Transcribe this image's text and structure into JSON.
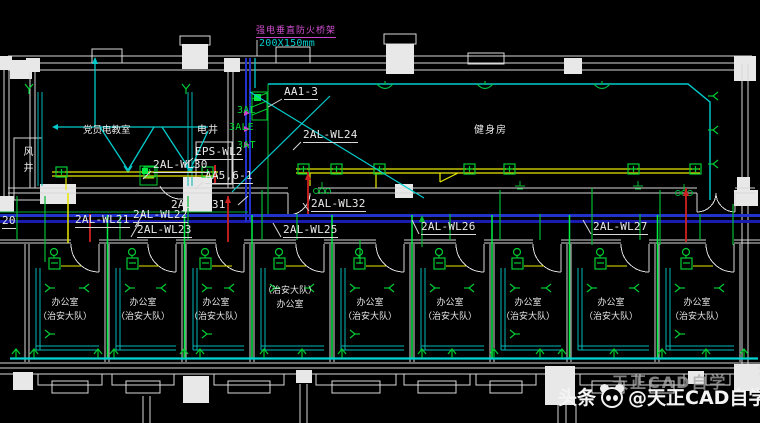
{
  "colors": {
    "background": "#000000",
    "wall_white": "#d9d9d9",
    "wire_cyan": "#00cccc",
    "wire_yellow": "#e8e800",
    "wire_green": "#00cc33",
    "riser_green_bright": "#00ee44",
    "tray_blue": "#2233cc",
    "wire_red": "#cc2222",
    "note_magenta": "#cc44cc"
  },
  "note": {
    "line1": "强电垂直防火桥架",
    "line2": "200X150mm"
  },
  "shaft_panels": {
    "p1": "3AL",
    "p2": "3ALE",
    "p3": "3AT"
  },
  "wire_labels": {
    "aa1_3": "AA1-3",
    "eps_wl2": "EPS-WL2",
    "wl30": "2AL-WL30",
    "aa5_6_1": "AA5,6-1",
    "wl31": "2AL-WL31",
    "wl24": "2AL-WL24",
    "wl32": "2AL-WL32",
    "wl20": "20",
    "wl21": "2AL-WL21",
    "wl22": "2AL-WL22",
    "wl23": "2AL-WL23",
    "wl25": "2AL-WL25",
    "wl26": "2AL-WL26",
    "wl27": "2AL-WL27"
  },
  "room_labels": {
    "party_room": "党员电教室",
    "wind_shaft": "风井",
    "electrical_shaft": "电井",
    "gym": "健身房"
  },
  "offices": [
    {
      "l1": "办公室",
      "l2": "（治安大队）"
    },
    {
      "l1": "办公室",
      "l2": "（治安大队）"
    },
    {
      "l1": "办公室",
      "l2": "（治安大队）"
    },
    {
      "l1": "（治安大队）",
      "l2": "办公室"
    },
    {
      "l1": "办公室",
      "l2": "（治安大队）"
    },
    {
      "l1": "办公室",
      "l2": "（治安大队）"
    },
    {
      "l1": "办公室",
      "l2": "（治安大队）"
    },
    {
      "l1": "办公室",
      "l2": "（治安大队）"
    },
    {
      "l1": "办公室",
      "l2": "（治安大队）"
    }
  ],
  "watermark": {
    "prefix": "头条",
    "handle": "@天正CAD自学",
    "shadow": "天正CAD自学",
    "logo": "panda-logo"
  }
}
